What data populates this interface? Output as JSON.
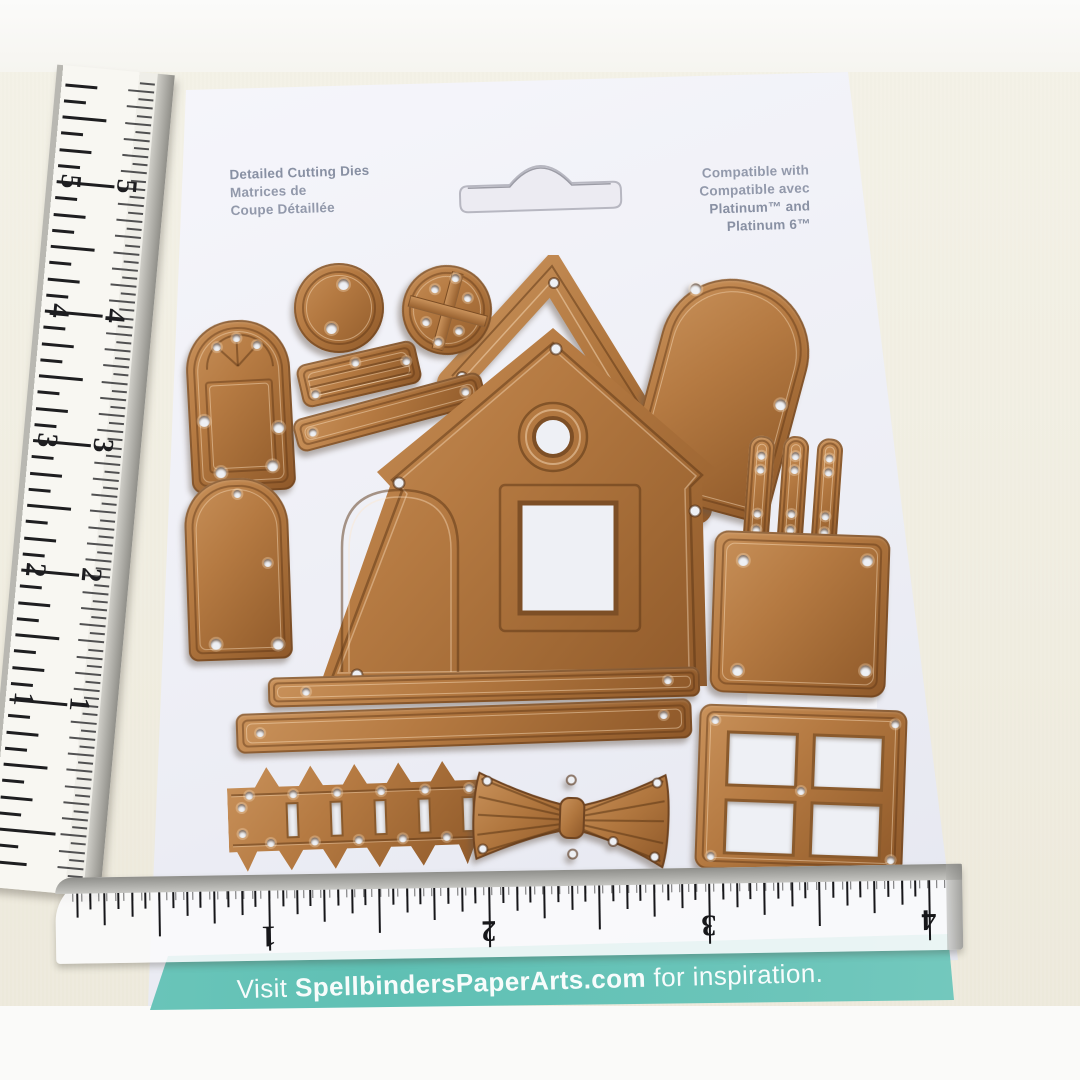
{
  "scene": {
    "description": "Photo of a Spellbinders gingerbread-house detailed cutting die set on its backing card, with a vertical ruler on the left and a clear horizontal ruler across the bottom"
  },
  "package": {
    "left_text": {
      "line1": "Detailed Cutting Dies",
      "line2": "Matrices de",
      "line3": "Coupe Détaillée"
    },
    "right_text": {
      "line1": "Compatible with",
      "line2": "Compatible avec",
      "line3": "Platinum™ and",
      "line4": "Platinum 6™"
    },
    "banner": {
      "prefix": "Visit ",
      "brand": "SpellbindersPaperArts.com",
      "suffix": " for inspiration."
    }
  },
  "rulers": {
    "bottom": {
      "numbers": [
        "1",
        "2",
        "3",
        "4"
      ]
    },
    "left": {
      "numbers": [
        "5",
        "4",
        "3",
        "2",
        "1"
      ]
    }
  },
  "colors": {
    "copper": "#b0763e",
    "teal": "#66c2b7",
    "card": "#eef0f6",
    "fabric": "#f1eee1"
  },
  "dies": [
    "cathedral-window-door",
    "circle-tag",
    "round-pane-window",
    "roof-ridge-slat",
    "rail-slat",
    "roof-gable",
    "house-front",
    "door",
    "arch-panel",
    "picket-trio",
    "square-panel",
    "long-rail",
    "long-rail-2",
    "picket-fence",
    "bow",
    "four-pane-window"
  ]
}
